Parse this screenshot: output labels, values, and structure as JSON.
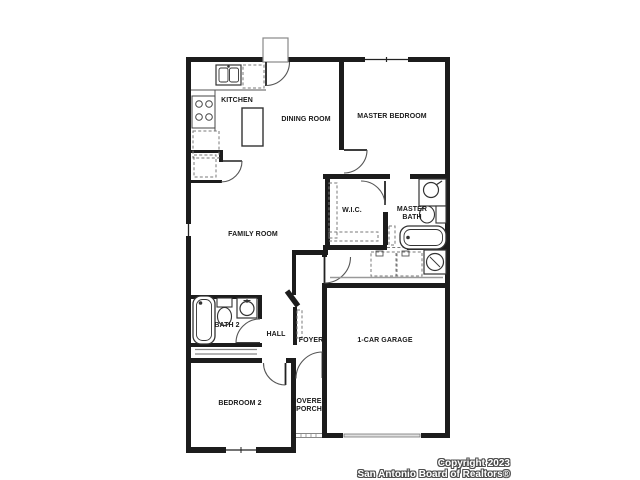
{
  "page": {
    "background": "#ffffff"
  },
  "plan": {
    "wall_color": "#1c1c1c",
    "line_color": "#555555",
    "rooms": {
      "kitchen": {
        "label": "KITCHEN"
      },
      "dining": {
        "label": "DINING ROOM"
      },
      "master_bedroom": {
        "label": "MASTER BEDROOM"
      },
      "family": {
        "label": "FAMILY ROOM"
      },
      "wic": {
        "label": "W.I.C."
      },
      "master_bath": {
        "label": "MASTER BATH"
      },
      "bath2": {
        "label": "BATH 2"
      },
      "hall": {
        "label": "HALL"
      },
      "foyer": {
        "label": "FOYER"
      },
      "garage": {
        "label": "1-CAR GARAGE"
      },
      "bedroom2": {
        "label": "BEDROOM 2"
      },
      "porch": {
        "label": "COVERED PORCH"
      }
    },
    "fixtures": [
      "kitchen-sink",
      "dishwasher",
      "range",
      "refrigerator",
      "kitchen-island",
      "pantry-shelves",
      "wic-shelving",
      "linen-shelves",
      "vanity-sink",
      "master-toilet",
      "master-tub",
      "washer",
      "dryer",
      "water-heater",
      "bath2-tub",
      "bath2-toilet",
      "bath2-sink",
      "bedroom2-closet-shelf",
      "coat-closet",
      "porch-steps",
      "rear-stoop"
    ],
    "doors": [
      "rear-door",
      "master-bedroom-door",
      "wic-door",
      "bath2-door",
      "bedroom2-door",
      "front-door",
      "laundry-door",
      "pantry-door",
      "garage-overhead-door"
    ],
    "windows": [
      "master-bedroom-window",
      "family-room-window",
      "bedroom2-window"
    ]
  },
  "footer": {
    "copyright_line1": "Copyright 2023",
    "copyright_line2": "San Antonio Board of Realtors®"
  }
}
